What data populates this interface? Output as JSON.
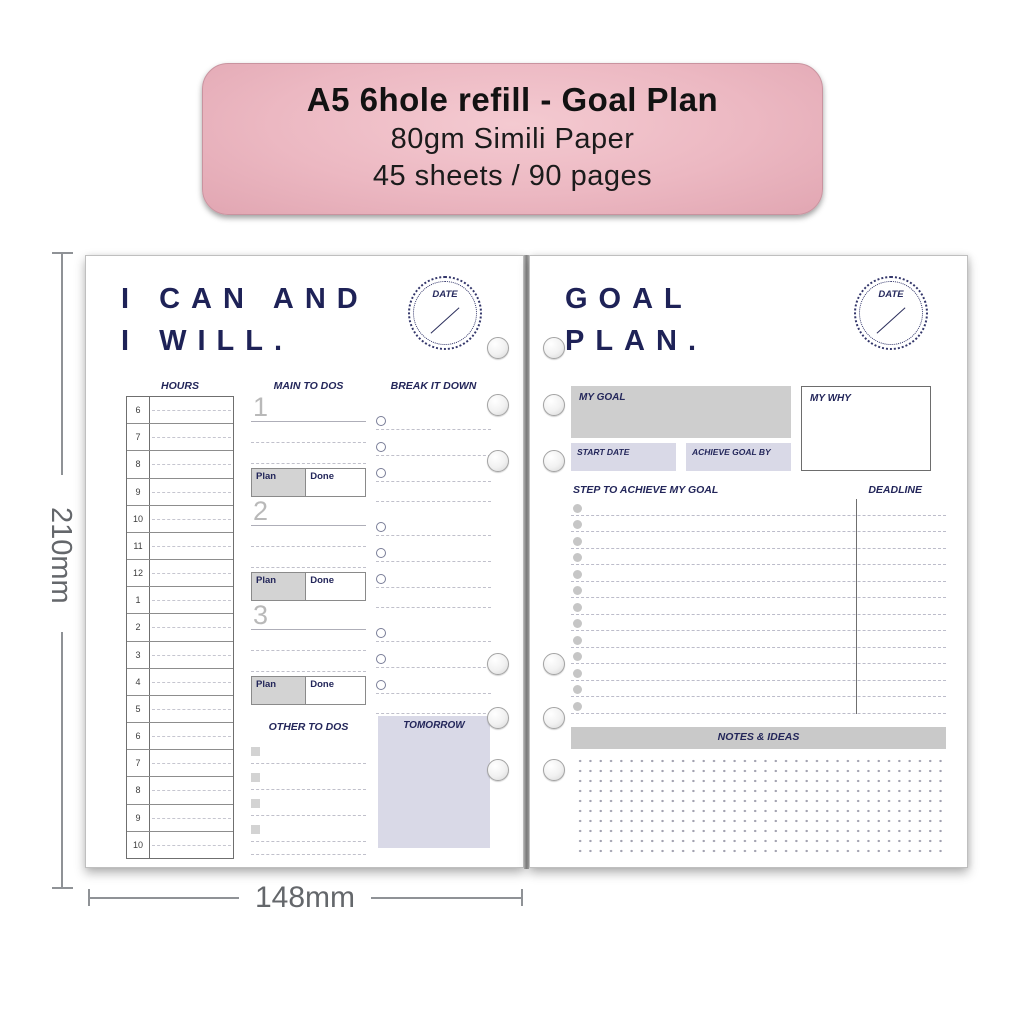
{
  "badge": {
    "title": "A5 6hole refill - Goal Plan",
    "subtitle_1": "80gm Simili Paper",
    "subtitle_2": "45 sheets / 90 pages"
  },
  "dimensions": {
    "height_label": "210mm",
    "width_label": "148mm"
  },
  "left_page": {
    "title_line_1": "I CAN AND",
    "title_line_2": "I WILL.",
    "date_stamp_label": "DATE",
    "hours": {
      "header": "HOURS",
      "rows": [
        "6",
        "7",
        "8",
        "9",
        "10",
        "11",
        "12",
        "1",
        "2",
        "3",
        "4",
        "5",
        "6",
        "7",
        "8",
        "9",
        "10"
      ]
    },
    "main_todos": {
      "header": "MAIN TO DOS",
      "sections": [
        {
          "number": "1",
          "plan_label": "Plan",
          "done_label": "Done"
        },
        {
          "number": "2",
          "plan_label": "Plan",
          "done_label": "Done"
        },
        {
          "number": "3",
          "plan_label": "Plan",
          "done_label": "Done"
        }
      ]
    },
    "break_it_down": {
      "header": "BREAK IT DOWN",
      "groups": 3,
      "items_per_group": 3
    },
    "other_todos": {
      "header": "OTHER TO DOS",
      "item_count": 4
    },
    "tomorrow_header": "TOMORROW"
  },
  "right_page": {
    "title_line_1": "GOAL",
    "title_line_2": "PLAN.",
    "date_stamp_label": "DATE",
    "my_goal_label": "MY GOAL",
    "my_why_label": "MY WHY",
    "start_date_label": "START DATE",
    "achieve_goal_by_label": "ACHIEVE GOAL BY",
    "steps_header": "STEP TO ACHIEVE MY GOAL",
    "deadline_header": "DEADLINE",
    "steps_count": 13,
    "notes_header": "NOTES & IDEAS"
  },
  "colors": {
    "badge_pink": "#ecb8c2",
    "navy_ink": "#1e2257",
    "lavender_fill": "#d9d9e7",
    "gray_fill": "#cecece",
    "dimension_gray": "#64676b"
  }
}
